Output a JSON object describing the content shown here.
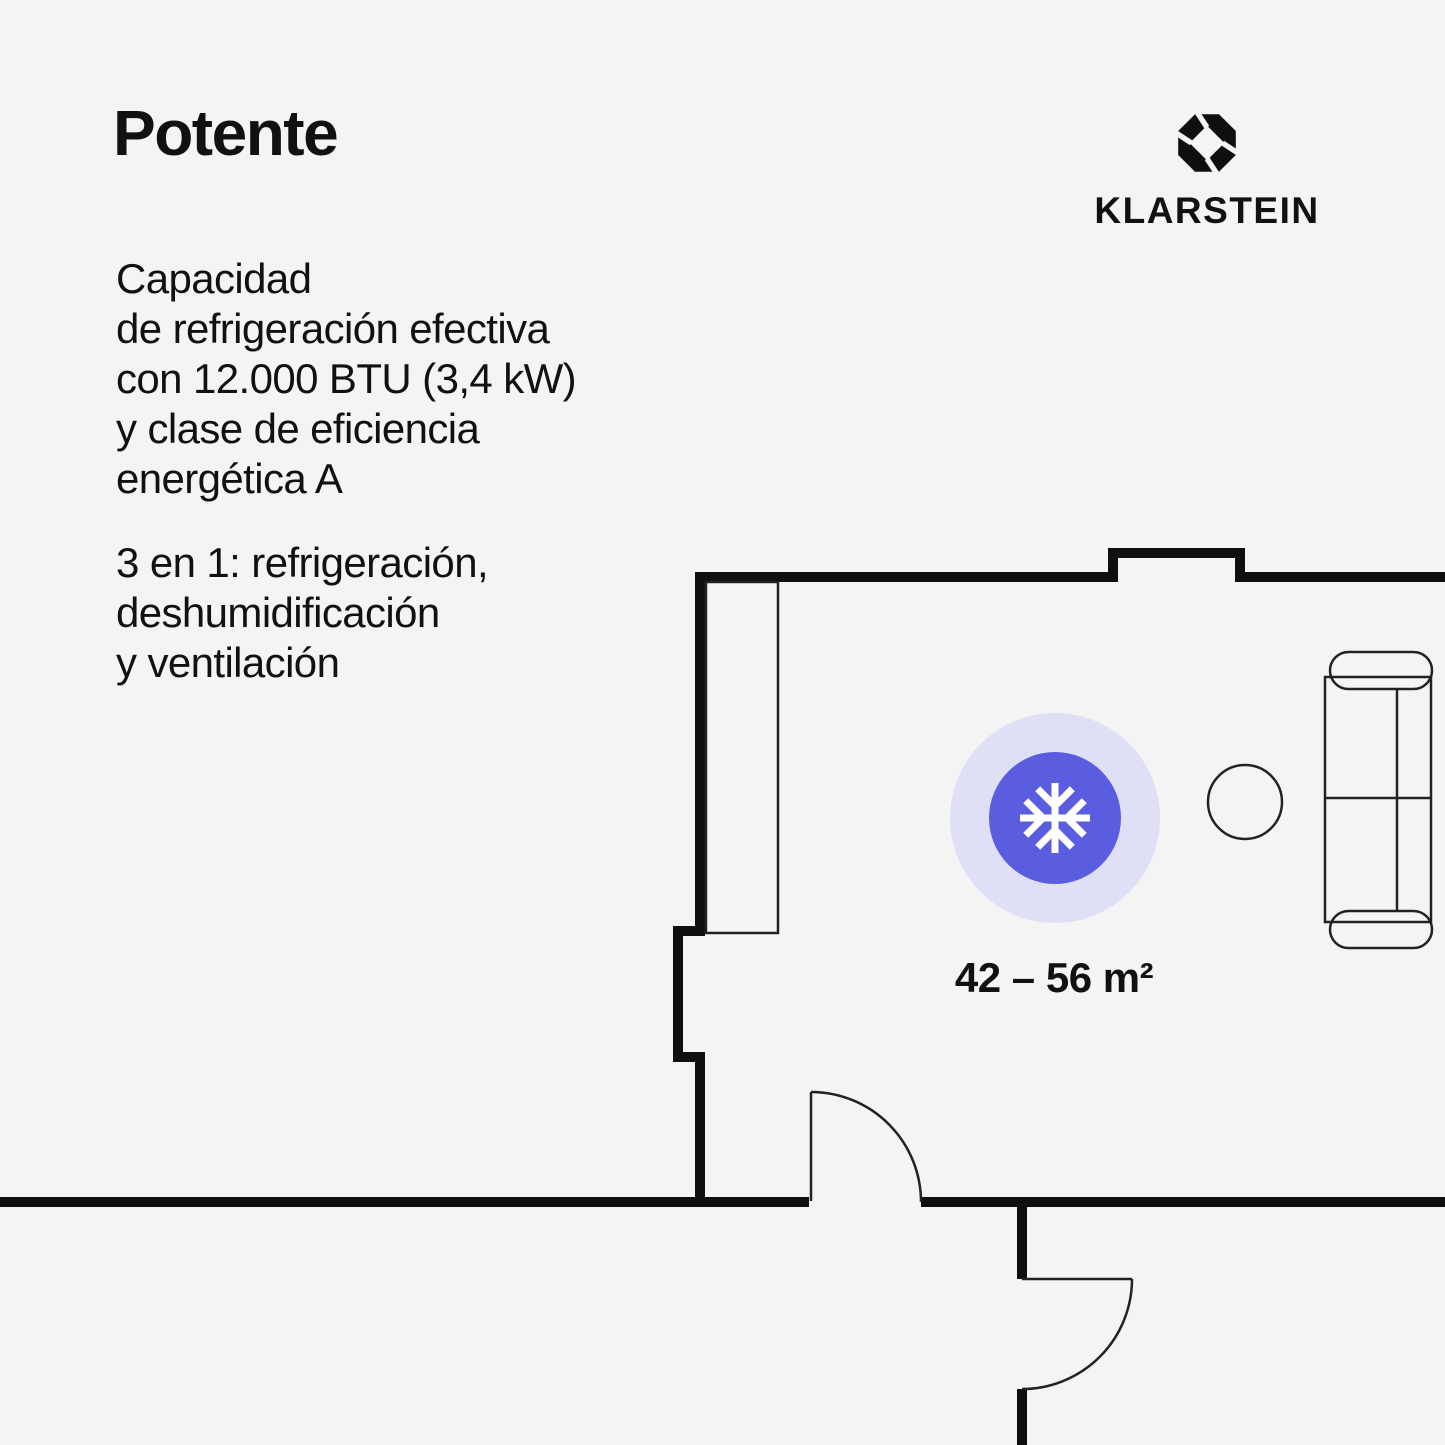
{
  "page": {
    "width_px": 1445,
    "height_px": 1445
  },
  "colors": {
    "background": "#f4f4f5",
    "text": "#111111",
    "wall": "#0f0f0f",
    "line": "#222222",
    "accent": "#5b5de0",
    "halo": "#dfe0f6",
    "icon": "#ffffff"
  },
  "header": {
    "title": "Potente"
  },
  "description": {
    "paragraph1": "Capacidad\nde refrigeración efectiva\ncon 12.000 BTU (3,4 kW)\ny clase de eficiencia\nenergética A",
    "paragraph2": "3 en 1: refrigeración,\ndeshumidificación\ny ventilación"
  },
  "brand": {
    "wordmark": "KLARSTEIN",
    "mark_icon": "klarstein-aperture-octagon"
  },
  "floor_plan": {
    "area_label": "42 – 56 m²",
    "cooling_icon": "snowflake-icon",
    "elements": [
      "exterior-walls",
      "wall-wardrobe",
      "swing-door-bottom",
      "swing-door-right",
      "sofa",
      "side-table",
      "cooling-radius"
    ]
  }
}
